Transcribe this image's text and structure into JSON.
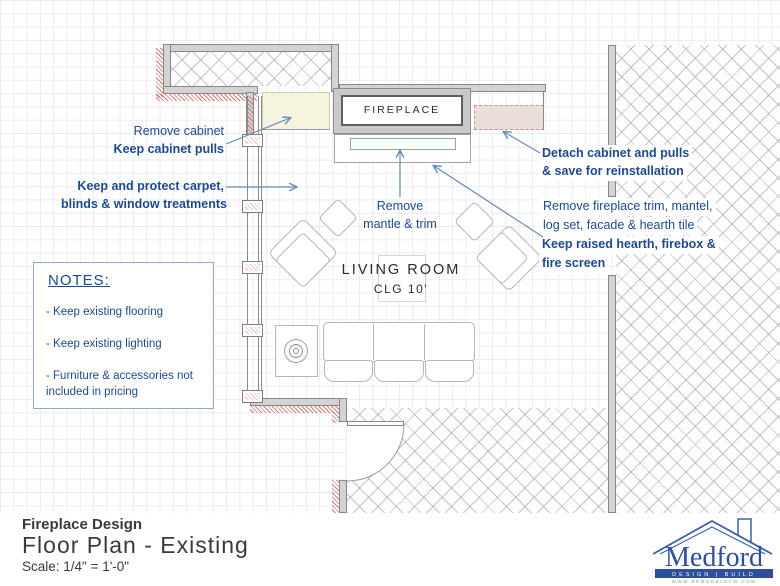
{
  "colors": {
    "annotation_blue": "#1e4a8d",
    "arrow_blue": "#6a8ab8",
    "wall_gray": "#d3d3d3",
    "demolition_red": "#c05548",
    "cabinet_cream": "#f6f3de",
    "cabinet_pink": "#eadedb",
    "hearth_green": "#85b585",
    "logo_blue": "#2d4f9e"
  },
  "plan": {
    "fireplace_label": "FIREPLACE",
    "room_name": "LIVING ROOM",
    "room_ceiling": "CLG 10'"
  },
  "annotations": {
    "remove_cabinet": "Remove cabinet",
    "keep_cabinet_pulls": "Keep cabinet pulls",
    "keep_carpet_line1": "Keep and protect carpet,",
    "keep_carpet_line2": "blinds & window treatments",
    "remove_mantle_line1": "Remove",
    "remove_mantle_line2": "mantle & trim",
    "detach_cabinet_line1": "Detach cabinet and pulls",
    "detach_cabinet_line2": "& save for reinstallation",
    "remove_fireplace_line1": "Remove fireplace trim, mantel,",
    "remove_fireplace_line2": "log set, facade & hearth tile",
    "keep_hearth_line1": "Keep raised hearth, firebox &",
    "keep_hearth_line2": "fire screen"
  },
  "notes": {
    "title": "NOTES:",
    "items": [
      "- Keep existing flooring",
      "- Keep existing lighting",
      "- Furniture & accessories not included in pricing"
    ]
  },
  "title_block": {
    "project": "Fireplace Design",
    "sheet": "Floor Plan - Existing",
    "scale": "Scale: 1/4\" = 1'-0\""
  },
  "logo": {
    "company": "Medford",
    "tagline": "DESIGN | BUILD",
    "website": "WWW.REMODELDFW.COM"
  }
}
